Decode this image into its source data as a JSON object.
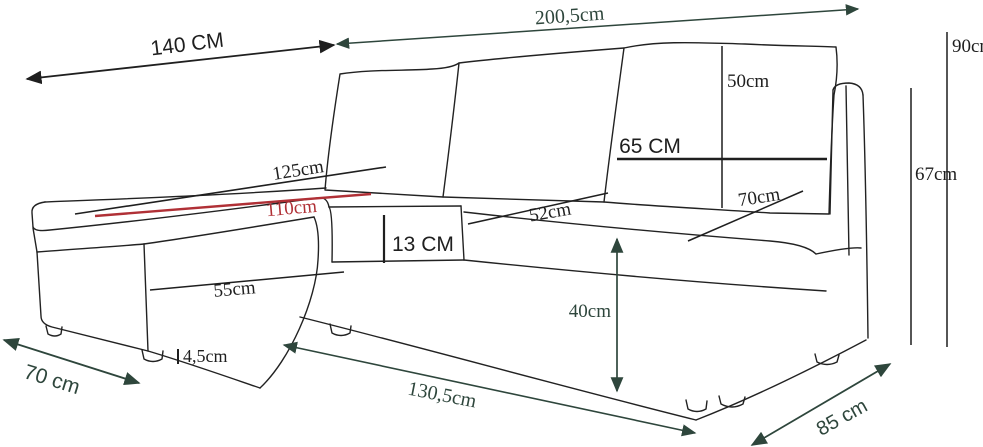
{
  "diagram": {
    "title": "Corner sofa dimension drawing",
    "colors": {
      "black": "#1f1f1f",
      "green": "#2e463c",
      "red": "#b03036",
      "background": "#ffffff"
    },
    "dimensions": [
      {
        "id": "chaise-length-top",
        "label": "140 CM",
        "font": "sans",
        "size": 21,
        "color": "black",
        "kind": "double-arrow",
        "stroke": 1.8,
        "line": [
          27,
          79,
          334,
          45
        ],
        "text": [
          188,
          51
        ],
        "rotation": -7,
        "anchor": "middle"
      },
      {
        "id": "total-length",
        "label": "200,5cm",
        "font": "serif",
        "size": 20,
        "color": "green",
        "kind": "double-arrow",
        "stroke": 1.5,
        "line": [
          337,
          44,
          858,
          9
        ],
        "text": [
          570,
          22
        ],
        "rotation": -4,
        "anchor": "middle"
      },
      {
        "id": "total-height",
        "label": "90cm",
        "font": "serif",
        "size": 19,
        "color": "black",
        "kind": "line",
        "stroke": 1.5,
        "line": [
          947,
          32,
          947,
          347
        ],
        "text": [
          952,
          52
        ],
        "rotation": 0,
        "anchor": "start"
      },
      {
        "id": "back-height",
        "label": "67cm",
        "font": "serif",
        "size": 19,
        "color": "black",
        "kind": "line",
        "stroke": 1.5,
        "line": [
          911,
          88,
          911,
          345
        ],
        "text": [
          915,
          180
        ],
        "rotation": 0,
        "anchor": "start"
      },
      {
        "id": "cushion-height",
        "label": "50cm",
        "font": "serif",
        "size": 19,
        "color": "black",
        "kind": "line",
        "stroke": 1.5,
        "line": [
          722,
          46,
          722,
          208
        ],
        "text": [
          727,
          87
        ],
        "rotation": 0,
        "anchor": "start"
      },
      {
        "id": "cushion-width",
        "label": "65 CM",
        "font": "sans",
        "size": 21,
        "color": "black",
        "kind": "line",
        "stroke": 2.6,
        "line": [
          617,
          159,
          827,
          159
        ],
        "text": [
          650,
          153
        ],
        "rotation": 0,
        "anchor": "middle"
      },
      {
        "id": "backrest-depth",
        "label": "70cm",
        "font": "serif",
        "size": 19,
        "color": "black",
        "kind": "line",
        "stroke": 1.5,
        "line": [
          688,
          241,
          803,
          191
        ],
        "text": [
          760,
          203
        ],
        "rotation": -9,
        "anchor": "middle"
      },
      {
        "id": "chaise-surface-length",
        "label": "125cm",
        "font": "serif",
        "size": 19,
        "color": "black",
        "kind": "line",
        "stroke": 1.6,
        "line": [
          75,
          214,
          386,
          167
        ],
        "text": [
          299,
          176
        ],
        "rotation": -9,
        "anchor": "middle"
      },
      {
        "id": "chaise-sleep-length",
        "label": "110cm",
        "font": "serif",
        "size": 19,
        "color": "red",
        "kind": "line",
        "stroke": 2.4,
        "line": [
          95,
          216,
          371,
          194
        ],
        "text": [
          292,
          214
        ],
        "rotation": -5,
        "anchor": "middle"
      },
      {
        "id": "seat-cushion-thickness",
        "label": "13 CM",
        "font": "sans",
        "size": 21,
        "color": "black",
        "kind": "line",
        "stroke": 2.2,
        "line": [
          384,
          215,
          384,
          263
        ],
        "text": [
          392,
          251
        ],
        "rotation": 0,
        "anchor": "start"
      },
      {
        "id": "seat-depth",
        "label": "52cm",
        "font": "serif",
        "size": 19,
        "color": "black",
        "kind": "line",
        "stroke": 1.5,
        "line": [
          468,
          224,
          608,
          193
        ],
        "text": [
          551,
          218
        ],
        "rotation": -10,
        "anchor": "middle"
      },
      {
        "id": "chaise-front-width",
        "label": "55cm",
        "font": "serif",
        "size": 19,
        "color": "black",
        "kind": "line",
        "stroke": 1.5,
        "line": [
          150,
          290,
          344,
          272
        ],
        "text": [
          235,
          295
        ],
        "rotation": -5,
        "anchor": "middle"
      },
      {
        "id": "leg-height",
        "label": "4,5cm",
        "font": "serif",
        "size": 18,
        "color": "black",
        "kind": "line",
        "stroke": 2,
        "line": [
          178,
          349,
          178,
          364
        ],
        "text": [
          183,
          362
        ],
        "rotation": 0,
        "anchor": "start"
      },
      {
        "id": "chaise-floor-width",
        "label": "70 cm",
        "font": "sans",
        "size": 21,
        "color": "green",
        "kind": "double-arrow",
        "stroke": 1.8,
        "line": [
          4,
          340,
          139,
          383
        ],
        "text": [
          50,
          386
        ],
        "rotation": 17,
        "anchor": "middle"
      },
      {
        "id": "front-floor-length",
        "label": "130,5cm",
        "font": "serif",
        "size": 20,
        "color": "green",
        "kind": "double-arrow",
        "stroke": 1.6,
        "line": [
          284,
          345,
          695,
          433
        ],
        "text": [
          441,
          401
        ],
        "rotation": 11,
        "anchor": "middle"
      },
      {
        "id": "seat-height",
        "label": "40cm",
        "font": "serif",
        "size": 19,
        "color": "green",
        "kind": "double-arrow",
        "stroke": 1.7,
        "line": [
          617,
          239,
          617,
          391
        ],
        "text": [
          611,
          317
        ],
        "rotation": 0,
        "anchor": "end"
      },
      {
        "id": "side-floor-depth",
        "label": "85 cm",
        "font": "sans",
        "size": 20,
        "color": "green",
        "kind": "double-arrow",
        "stroke": 1.8,
        "line": [
          752,
          445,
          890,
          364
        ],
        "text": [
          845,
          423
        ],
        "rotation": -29,
        "anchor": "middle"
      }
    ]
  }
}
